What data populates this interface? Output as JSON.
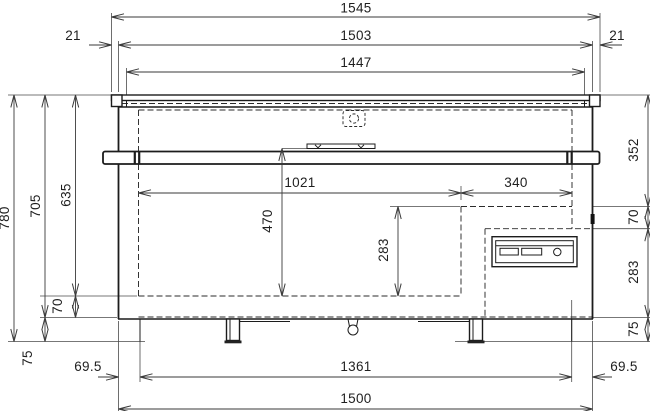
{
  "drawing": {
    "title": "chest-freezer-front-elevation",
    "units": "mm",
    "background": "#ffffff",
    "line_color": "#1c1c1c",
    "dim_color": "#3a3a3a",
    "dims": {
      "lid_overall": "1545",
      "overhang_left": "21",
      "lid_body": "1503",
      "overhang_right": "21",
      "lid_inner": "1447",
      "overall_height": "780",
      "height_to_base": "705",
      "interior_height": "635",
      "bottom_insulation": "70",
      "plinth_left": "75",
      "top_to_step": "352",
      "step_gap": "70",
      "compartment_height": "283",
      "plinth_right": "75",
      "interior_length": "1021",
      "step_length": "340",
      "interior_depth": "470",
      "step_height": "283",
      "foot_inset_left": "69.5",
      "foot_span": "1361",
      "foot_inset_right": "69.5",
      "base_width": "1500"
    }
  }
}
